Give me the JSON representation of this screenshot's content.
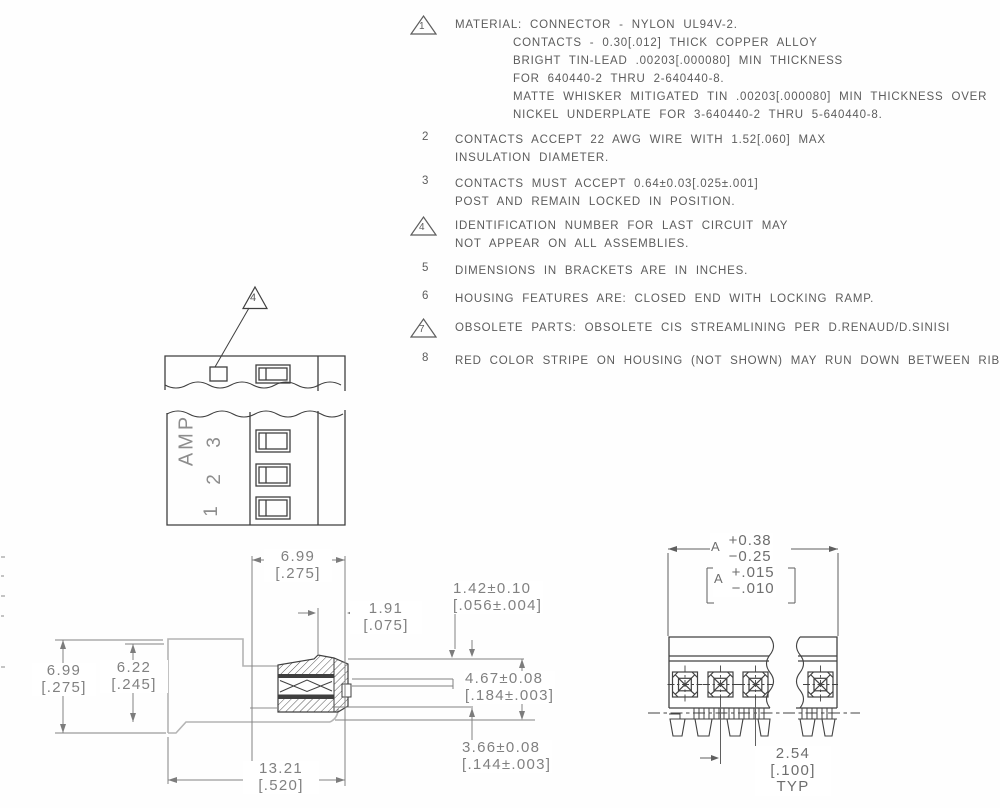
{
  "drawing": {
    "notes": [
      {
        "number": "1",
        "flag": "triangle",
        "lines": [
          "MATERIAL: CONNECTOR - NYLON UL94V-2.",
          "CONTACTS - 0.30[.012] THICK COPPER ALLOY",
          "BRIGHT TIN-LEAD .00203[.000080] MIN THICKNESS",
          "FOR 640440-2 THRU 2-640440-8.",
          "MATTE WHISKER MITIGATED TIN .00203[.000080] MIN THICKNESS OVER",
          "NICKEL UNDERPLATE FOR 3-640440-2 THRU 5-640440-8."
        ]
      },
      {
        "number": "2",
        "flag": "plain",
        "lines": [
          "CONTACTS ACCEPT 22 AWG WIRE WITH 1.52[.060] MAX",
          "INSULATION DIAMETER."
        ]
      },
      {
        "number": "3",
        "flag": "plain",
        "lines": [
          "CONTACTS MUST ACCEPT 0.64±0.03[.025±.001]",
          "POST AND REMAIN LOCKED IN POSITION."
        ]
      },
      {
        "number": "4",
        "flag": "triangle",
        "lines": [
          "IDENTIFICATION NUMBER FOR LAST CIRCUIT MAY",
          "NOT APPEAR ON ALL ASSEMBLIES."
        ]
      },
      {
        "number": "5",
        "flag": "plain",
        "lines": [
          "DIMENSIONS IN BRACKETS ARE IN INCHES."
        ]
      },
      {
        "number": "6",
        "flag": "plain",
        "lines": [
          "HOUSING FEATURES ARE: CLOSED END WITH LOCKING RAMP."
        ]
      },
      {
        "number": "7",
        "flag": "triangle",
        "lines": [
          "OBSOLETE PARTS: OBSOLETE CIS STREAMLINING PER D.RENAUD/D.SINISI"
        ]
      },
      {
        "number": "8",
        "flag": "plain",
        "lines": [
          "RED COLOR STRIPE ON HOUSING (NOT SHOWN) MAY RUN DOWN BETWEEN RIBS."
        ]
      }
    ],
    "top_view": {
      "brand_label": "AMP",
      "circuit_numbers": [
        "3",
        "2",
        "1"
      ],
      "callout_flag": "4"
    },
    "side_view": {
      "dim_width_top_mm": "6.99",
      "dim_width_top_in": "[.275]",
      "dim_offset_mm": "1.91",
      "dim_offset_in": "[.075]",
      "dim_tab_mm": "1.42±0.10",
      "dim_tab_in": "[.056±.004]",
      "dim_mid_mm": "4.67±0.08",
      "dim_mid_in": "[.184±.003]",
      "dim_lower_mm": "3.66±0.08",
      "dim_lower_in": "[.144±.003]",
      "dim_length_mm": "13.21",
      "dim_length_in": "[.520]",
      "dim_height_mm": "6.99",
      "dim_height_in": "[.275]",
      "dim_body_mm": "6.22",
      "dim_body_in": "[.245]"
    },
    "front_view": {
      "dim_a_label": "A",
      "dim_a_plus": "+0.38",
      "dim_a_minus": "−0.25",
      "dim_a_in_label": "A",
      "dim_a_in_plus": "+.015",
      "dim_a_in_minus": "−.010",
      "dim_pitch_mm": "2.54",
      "dim_pitch_in": "[.100]",
      "dim_pitch_qual": "TYP"
    },
    "colors": {
      "line_dark": "#3f3f3f",
      "profile_gray": "#b4b4b4",
      "dim_gray": "#7f7f7f",
      "note_text": "#5c5c5c"
    }
  }
}
